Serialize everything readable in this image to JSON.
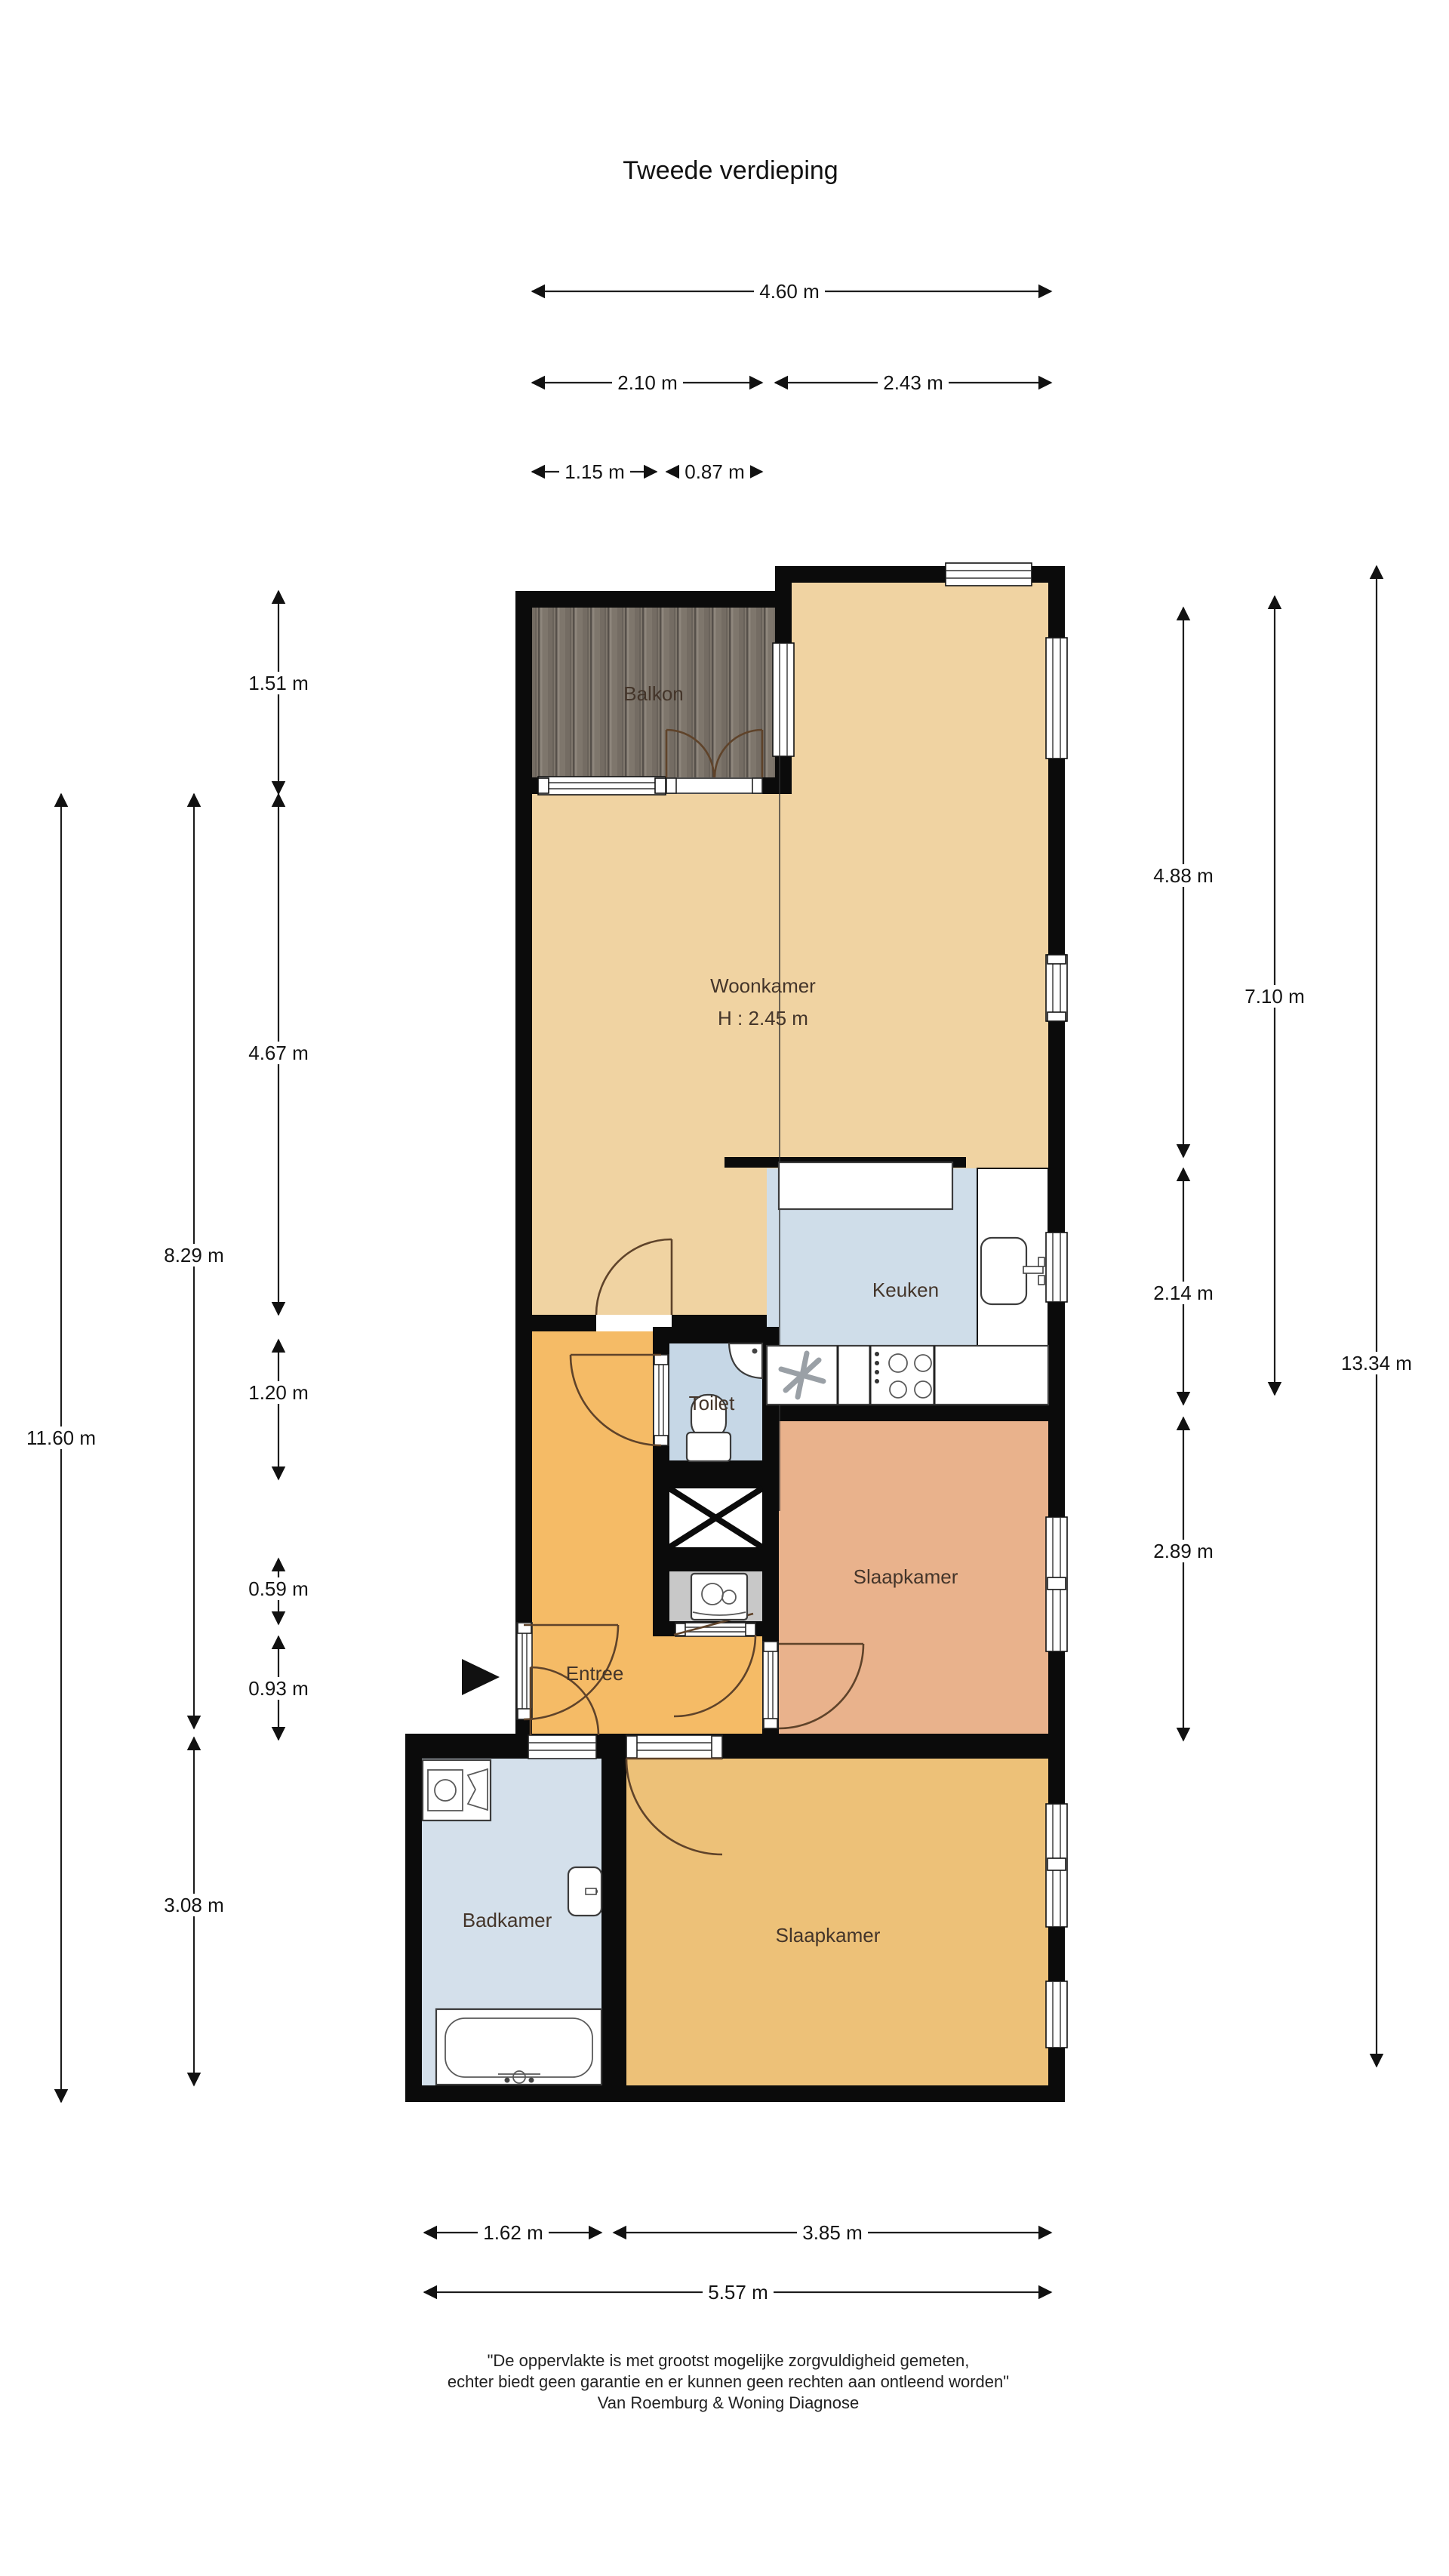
{
  "title": "Tweede verdieping",
  "rooms": {
    "balkon": {
      "label": "Balkon"
    },
    "woonkamer": {
      "label": "Woonkamer",
      "height": "H : 2.45 m"
    },
    "keuken": {
      "label": "Keuken"
    },
    "toilet": {
      "label": "Toilet"
    },
    "slaapkamer_1": {
      "label": "Slaapkamer"
    },
    "entree": {
      "label": "Entree"
    },
    "badkamer": {
      "label": "Badkamer"
    },
    "slaapkamer_2": {
      "label": "Slaapkamer"
    }
  },
  "dimensions": {
    "top": [
      {
        "label": "4.60 m"
      },
      {
        "label": "2.10 m"
      },
      {
        "label": "2.43 m"
      },
      {
        "label": "1.15 m"
      },
      {
        "label": "0.87 m"
      }
    ],
    "left": [
      {
        "label": "1.51 m"
      },
      {
        "label": "4.67 m"
      },
      {
        "label": "1.20 m"
      },
      {
        "label": "0.59 m"
      },
      {
        "label": "0.93 m"
      },
      {
        "label": "8.29 m"
      },
      {
        "label": "3.08 m"
      },
      {
        "label": "11.60 m"
      }
    ],
    "right": [
      {
        "label": "4.88 m"
      },
      {
        "label": "2.14 m"
      },
      {
        "label": "2.89 m"
      },
      {
        "label": "7.10 m"
      },
      {
        "label": "13.34 m"
      }
    ],
    "bottom": [
      {
        "label": "1.62 m"
      },
      {
        "label": "3.85 m"
      },
      {
        "label": "5.57 m"
      }
    ]
  },
  "footer": {
    "line1": "\"De oppervlakte is met grootst mogelijke zorgvuldigheid gemeten,",
    "line2": "echter biedt geen garantie en er kunnen geen rechten aan ontleend worden\"",
    "line3": "Van Roemburg & Woning Diagnose"
  },
  "colors": {
    "wall": "#0b0b0b",
    "woonkamer": "#f0d3a2",
    "entree": "#f5bb66",
    "slaapkamer_top": "#e9b28c",
    "slaapkamer_bottom": "#edc178",
    "keuken": "#cfdde9",
    "toilet": "#c6d7e6",
    "badkamer": "#d4e0eb",
    "washroom": "#c8c8c8",
    "balkon_wood": "#7e766c",
    "door_arc": "#5f432a"
  }
}
